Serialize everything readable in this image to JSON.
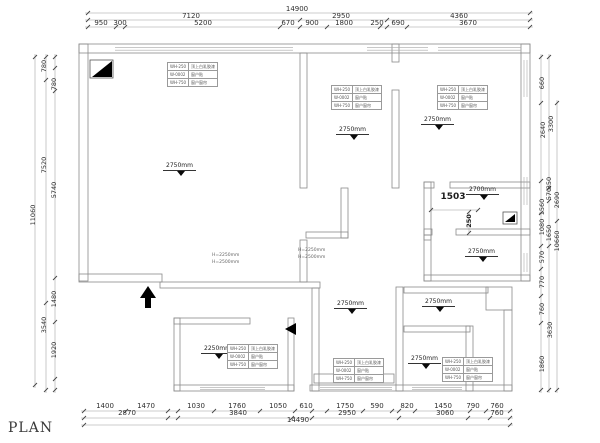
{
  "plan_label": "PLAN",
  "colors": {
    "wall_line": "#8b8b8b",
    "dim_text": "#2e2e2e",
    "symbol": "#000000"
  },
  "dims": {
    "top": [
      {
        "v": "14900",
        "x": 297,
        "y": 6
      },
      {
        "v": "7120",
        "x": 191,
        "y": 13
      },
      {
        "v": "2950",
        "x": 341,
        "y": 13
      },
      {
        "v": "4360",
        "x": 459,
        "y": 13
      },
      {
        "v": "950",
        "x": 101,
        "y": 20
      },
      {
        "v": "300",
        "x": 120,
        "y": 20
      },
      {
        "v": "5200",
        "x": 203,
        "y": 20
      },
      {
        "v": "670",
        "x": 288,
        "y": 20
      },
      {
        "v": "900",
        "x": 312,
        "y": 20
      },
      {
        "v": "1800",
        "x": 344,
        "y": 20
      },
      {
        "v": "250",
        "x": 377,
        "y": 20
      },
      {
        "v": "690",
        "x": 398,
        "y": 20
      },
      {
        "v": "3670",
        "x": 468,
        "y": 20
      }
    ],
    "bottom": [
      {
        "v": "1400",
        "x": 105,
        "y": 403
      },
      {
        "v": "1470",
        "x": 146,
        "y": 403
      },
      {
        "v": "1030",
        "x": 196,
        "y": 403
      },
      {
        "v": "1760",
        "x": 237,
        "y": 403
      },
      {
        "v": "1050",
        "x": 278,
        "y": 403
      },
      {
        "v": "610",
        "x": 306,
        "y": 403
      },
      {
        "v": "1750",
        "x": 345,
        "y": 403
      },
      {
        "v": "590",
        "x": 377,
        "y": 403
      },
      {
        "v": "820",
        "x": 407,
        "y": 403
      },
      {
        "v": "1450",
        "x": 443,
        "y": 403
      },
      {
        "v": "790",
        "x": 473,
        "y": 403
      },
      {
        "v": "760",
        "x": 497,
        "y": 403
      },
      {
        "v": "2870",
        "x": 127,
        "y": 410
      },
      {
        "v": "3840",
        "x": 238,
        "y": 410
      },
      {
        "v": "2950",
        "x": 347,
        "y": 410
      },
      {
        "v": "3060",
        "x": 445,
        "y": 410
      },
      {
        "v": "760",
        "x": 497,
        "y": 410
      },
      {
        "v": "14490",
        "x": 298,
        "y": 417
      }
    ],
    "left": [
      {
        "v": "780",
        "x": 44,
        "y": 66
      },
      {
        "v": "780",
        "x": 54,
        "y": 84
      },
      {
        "v": "7520",
        "x": 44,
        "y": 165
      },
      {
        "v": "5740",
        "x": 54,
        "y": 190
      },
      {
        "v": "11060",
        "x": 33,
        "y": 215
      },
      {
        "v": "1480",
        "x": 54,
        "y": 299
      },
      {
        "v": "3540",
        "x": 44,
        "y": 325
      },
      {
        "v": "1920",
        "x": 54,
        "y": 350
      }
    ],
    "right": [
      {
        "v": "660",
        "x": 542,
        "y": 83
      },
      {
        "v": "3300",
        "x": 551,
        "y": 124
      },
      {
        "v": "2640",
        "x": 543,
        "y": 130
      },
      {
        "v": "350",
        "x": 549,
        "y": 183
      },
      {
        "v": "570",
        "x": 549,
        "y": 194
      },
      {
        "v": "2690",
        "x": 557,
        "y": 200
      },
      {
        "v": "1560",
        "x": 542,
        "y": 207
      },
      {
        "v": "1080",
        "x": 542,
        "y": 227
      },
      {
        "v": "1650",
        "x": 549,
        "y": 233
      },
      {
        "v": "10660",
        "x": 557,
        "y": 241
      },
      {
        "v": "570",
        "x": 542,
        "y": 257
      },
      {
        "v": "770",
        "x": 542,
        "y": 282
      },
      {
        "v": "760",
        "x": 542,
        "y": 309
      },
      {
        "v": "3630",
        "x": 550,
        "y": 330
      },
      {
        "v": "1860",
        "x": 542,
        "y": 364
      }
    ]
  },
  "height_markers": [
    {
      "v": "2750mm",
      "x": 163,
      "y": 163
    },
    {
      "v": "2750mm",
      "x": 336,
      "y": 127
    },
    {
      "v": "2750mm",
      "x": 421,
      "y": 117
    },
    {
      "v": "2700mm",
      "x": 466,
      "y": 187
    },
    {
      "v": "2750mm",
      "x": 465,
      "y": 249
    },
    {
      "v": "2250mm",
      "x": 201,
      "y": 346
    },
    {
      "v": "2750mm",
      "x": 334,
      "y": 301
    },
    {
      "v": "2750mm",
      "x": 422,
      "y": 299
    },
    {
      "v": "2750mm",
      "x": 408,
      "y": 356
    }
  ],
  "schedule_rows": [
    {
      "c": "WH-250",
      "l": "顶上白乳胶漆"
    },
    {
      "c": "W-0002",
      "l": "窗户贴"
    },
    {
      "c": "WH-750",
      "l": "窗户窗帘"
    }
  ],
  "tables": [
    {
      "x": 167,
      "y": 62
    },
    {
      "x": 331,
      "y": 85
    },
    {
      "x": 437,
      "y": 85
    },
    {
      "x": 227,
      "y": 344
    },
    {
      "x": 333,
      "y": 358
    },
    {
      "x": 442,
      "y": 357
    }
  ],
  "notes": [
    {
      "x": 212,
      "y": 252,
      "lines": [
        "H=2250mm",
        "H=2500mm"
      ]
    },
    {
      "x": 298,
      "y": 247,
      "lines": [
        "H=2250mm",
        "H=2500mm"
      ]
    }
  ],
  "inline_dims": [
    {
      "v": "1503",
      "x": 453,
      "y": 197,
      "rot": 0,
      "fs": 9
    },
    {
      "v": "250",
      "x": 469,
      "y": 221,
      "rot": -90,
      "fs": 6.5
    }
  ]
}
